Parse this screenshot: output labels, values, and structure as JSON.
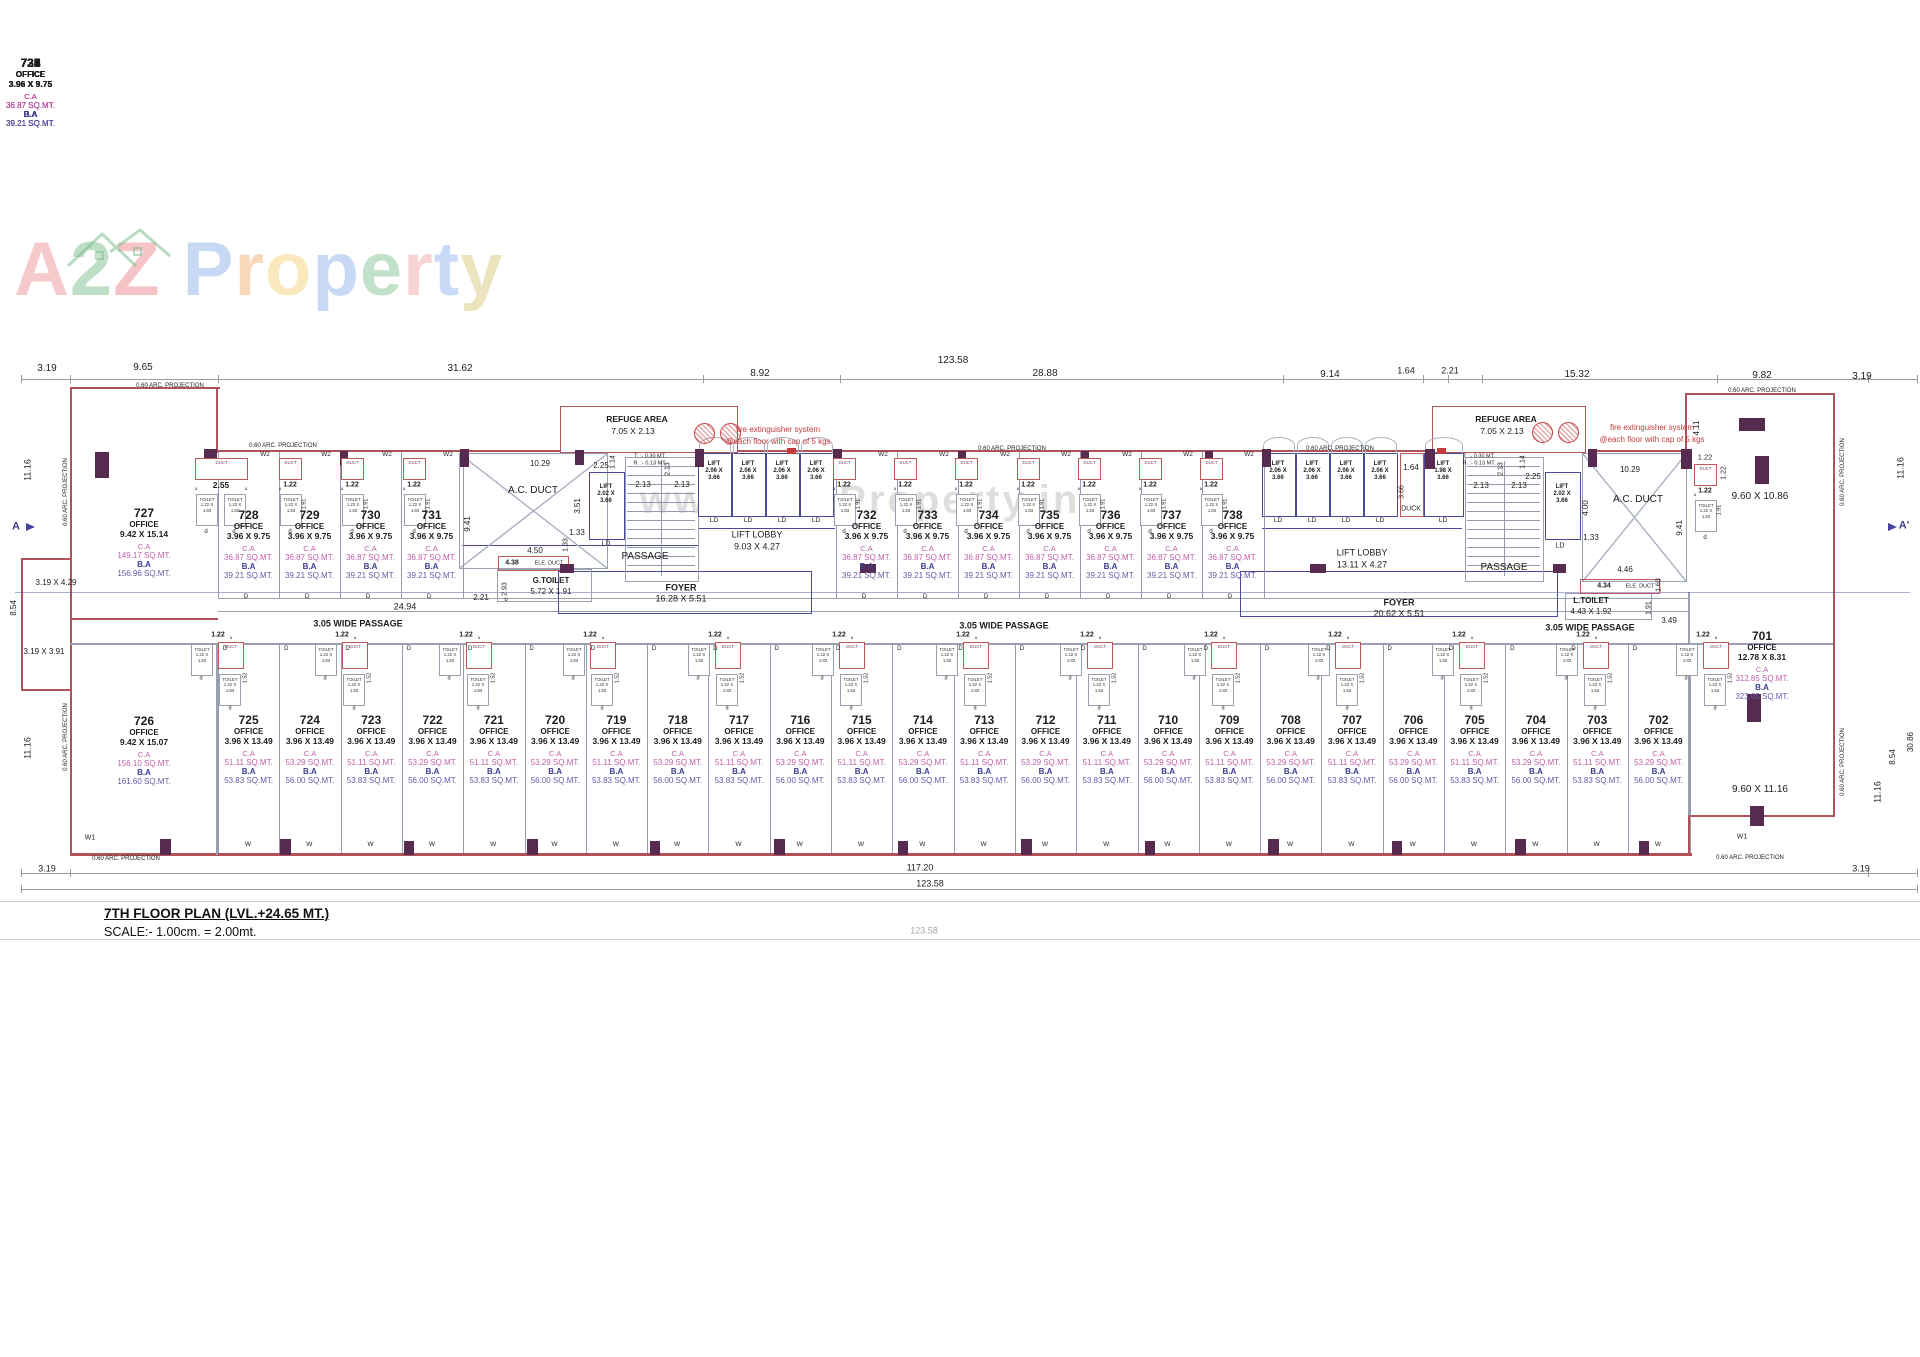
{
  "logo": {
    "word1": [
      {
        "ch": "A",
        "c": "#ef9597"
      },
      {
        "ch": "2",
        "c": "#7fbe8f"
      },
      {
        "ch": "Z",
        "c": "#ee8a90"
      }
    ],
    "word2": [
      {
        "ch": "P",
        "c": "#8fb3ea"
      },
      {
        "ch": "r",
        "c": "#f2b079"
      },
      {
        "ch": "o",
        "c": "#f6d57e"
      },
      {
        "ch": "p",
        "c": "#93b5ec"
      },
      {
        "ch": "e",
        "c": "#84c492"
      },
      {
        "ch": "r",
        "c": "#f0a9a9"
      },
      {
        "ch": "t",
        "c": "#95b7ee"
      },
      {
        "ch": "y",
        "c": "#d9cb7f"
      }
    ]
  },
  "watermark_text": "www.A2ZProperty.in",
  "title_block": {
    "line1": "7TH FLOOR PLAN (LVL.+24.65 MT.)",
    "line2": "SCALE:- 1.00cm. = 2.00mt."
  },
  "labels": {
    "office": "OFFICE",
    "ca": "C.A",
    "ba": "B.A",
    "lift": "LIFT",
    "lift_w": "2.06 X",
    "lift_h": "3.66",
    "ld": "LD",
    "toilet": "TOILET",
    "toilet_w": "1.22 X",
    "toilet_h": "1.83",
    "duct": "DUCT",
    "duck": "DUCK",
    "w2": "W2",
    "door": "D",
    "window": "W",
    "d_small": "d",
    "u_small": "u",
    "dim_122": "1.22",
    "dim_255": "2.55",
    "dim_152": "1.52",
    "dim_191": "1.91"
  },
  "lift_small": {
    "w": "2.02 X"
  },
  "lift_198": {
    "w": "1.98 X"
  },
  "office_701": {
    "no": "701",
    "size": "12.78 X 8.31",
    "ca": "312.85 SQ.MT.",
    "ba": "323.05 SQ.MT."
  },
  "offices_top": [
    {
      "no": "727",
      "size": "9.42 X 15.14",
      "ca": "149.17 SQ.MT.",
      "ba": "156.96 SQ.MT."
    },
    {
      "no": "728",
      "size": "3.96 X 9.75",
      "ca": "36.87 SQ.MT.",
      "ba": "39.21 SQ.MT."
    },
    {
      "no": "729",
      "size": "3.96 X 9.75",
      "ca": "36.87 SQ.MT.",
      "ba": "39.21 SQ.MT."
    },
    {
      "no": "730",
      "size": "3.96 X 9.75",
      "ca": "36.87 SQ.MT.",
      "ba": "39.21 SQ.MT."
    },
    {
      "no": "731",
      "size": "3.96 X 9.75",
      "ca": "36.87 SQ.MT.",
      "ba": "39.21 SQ.MT."
    },
    {
      "no": "732",
      "size": "3.96 X 9.75",
      "ca": "36.87 SQ.MT.",
      "ba": "39.21 SQ.MT."
    },
    {
      "no": "733",
      "size": "3.96 X 9.75",
      "ca": "36.87 SQ.MT.",
      "ba": "39.21 SQ.MT."
    },
    {
      "no": "734",
      "size": "3.96 X 9.75",
      "ca": "36.87 SQ.MT.",
      "ba": "39.21 SQ.MT."
    },
    {
      "no": "735",
      "size": "3.96 X 9.75",
      "ca": "36.87 SQ.MT.",
      "ba": "39.21 SQ.MT."
    },
    {
      "no": "736",
      "size": "3.96 X 9.75",
      "ca": "36.87 SQ.MT.",
      "ba": "39.21 SQ.MT."
    },
    {
      "no": "737",
      "size": "3.96 X 9.75",
      "ca": "36.87 SQ.MT.",
      "ba": "39.21 SQ.MT."
    },
    {
      "no": "738",
      "size": "3.96 X 9.75",
      "ca": "36.87 SQ.MT.",
      "ba": "39.21 SQ.MT."
    }
  ],
  "offices_bottom": [
    {
      "no": "726",
      "size": "9.42 X 15.07",
      "ca": "156.10 SQ.MT.",
      "ba": "161.60 SQ.MT."
    },
    {
      "no": "725",
      "size": "3.96 X 13.49",
      "ca": "51.11 SQ.MT.",
      "ba": "53.83 SQ.MT."
    },
    {
      "no": "724",
      "size": "3.96 X 13.49",
      "ca": "53.29 SQ.MT.",
      "ba": "56.00 SQ.MT."
    },
    {
      "no": "723",
      "size": "3.96 X 13.49",
      "ca": "51.11 SQ.MT.",
      "ba": "53.83 SQ.MT."
    },
    {
      "no": "722",
      "size": "3.96 X 13.49",
      "ca": "53.29 SQ.MT.",
      "ba": "56.00 SQ.MT."
    },
    {
      "no": "721",
      "size": "3.96 X 13.49",
      "ca": "51.11 SQ.MT.",
      "ba": "53.83 SQ.MT."
    },
    {
      "no": "720",
      "size": "3.96 X 13.49",
      "ca": "53.29 SQ.MT.",
      "ba": "56.00 SQ.MT."
    },
    {
      "no": "719",
      "size": "3.96 X 13.49",
      "ca": "51.11 SQ.MT.",
      "ba": "53.83 SQ.MT."
    },
    {
      "no": "718",
      "size": "3.96 X 13.49",
      "ca": "53.29 SQ.MT.",
      "ba": "56.00 SQ.MT."
    },
    {
      "no": "717",
      "size": "3.96 X 13.49",
      "ca": "51.11 SQ.MT.",
      "ba": "53.83 SQ.MT."
    },
    {
      "no": "716",
      "size": "3.96 X 13.49",
      "ca": "53.29 SQ.MT.",
      "ba": "56.00 SQ.MT."
    },
    {
      "no": "715",
      "size": "3.96 X 13.49",
      "ca": "51.11 SQ.MT.",
      "ba": "53.83 SQ.MT."
    },
    {
      "no": "714",
      "size": "3.96 X 13.49",
      "ca": "53.29 SQ.MT.",
      "ba": "56.00 SQ.MT."
    },
    {
      "no": "713",
      "size": "3.96 X 13.49",
      "ca": "51.11 SQ.MT.",
      "ba": "53.83 SQ.MT."
    },
    {
      "no": "712",
      "size": "3.96 X 13.49",
      "ca": "53.29 SQ.MT.",
      "ba": "56.00 SQ.MT."
    },
    {
      "no": "711",
      "size": "3.96 X 13.49",
      "ca": "51.11 SQ.MT.",
      "ba": "53.83 SQ.MT."
    },
    {
      "no": "710",
      "size": "3.96 X 13.49",
      "ca": "53.29 SQ.MT.",
      "ba": "56.00 SQ.MT."
    },
    {
      "no": "709",
      "size": "3.96 X 13.49",
      "ca": "51.11 SQ.MT.",
      "ba": "53.83 SQ.MT."
    },
    {
      "no": "708",
      "size": "3.96 X 13.49",
      "ca": "53.29 SQ.MT.",
      "ba": "56.00 SQ.MT."
    },
    {
      "no": "707",
      "size": "3.96 X 13.49",
      "ca": "51.11 SQ.MT.",
      "ba": "53.83 SQ.MT."
    },
    {
      "no": "706",
      "size": "3.96 X 13.49",
      "ca": "53.29 SQ.MT.",
      "ba": "56.00 SQ.MT."
    },
    {
      "no": "705",
      "size": "3.96 X 13.49",
      "ca": "51.11 SQ.MT.",
      "ba": "53.83 SQ.MT."
    },
    {
      "no": "704",
      "size": "3.96 X 13.49",
      "ca": "53.29 SQ.MT.",
      "ba": "56.00 SQ.MT."
    },
    {
      "no": "703",
      "size": "3.96 X 13.49",
      "ca": "51.11 SQ.MT.",
      "ba": "53.83 SQ.MT."
    },
    {
      "no": "702",
      "size": "3.96 X 13.49",
      "ca": "53.29 SQ.MT.",
      "ba": "56.00 SQ.MT."
    }
  ],
  "annotations": [
    {
      "t": "3.19",
      "x": 47,
      "y": 369,
      "s": 10
    },
    {
      "t": "9.65",
      "x": 143,
      "y": 368,
      "s": 10
    },
    {
      "t": "31.62",
      "x": 460,
      "y": 369,
      "s": 10
    },
    {
      "t": "8.92",
      "x": 760,
      "y": 374,
      "s": 10
    },
    {
      "t": "123.58",
      "x": 953,
      "y": 361,
      "s": 10
    },
    {
      "t": "28.88",
      "x": 1045,
      "y": 374,
      "s": 10
    },
    {
      "t": "9.14",
      "x": 1330,
      "y": 375,
      "s": 10
    },
    {
      "t": "1.64",
      "x": 1406,
      "y": 371,
      "s": 9
    },
    {
      "t": "2.21",
      "x": 1450,
      "y": 371,
      "s": 9
    },
    {
      "t": "15.32",
      "x": 1577,
      "y": 375,
      "s": 10
    },
    {
      "t": "9.82",
      "x": 1762,
      "y": 376,
      "s": 10
    },
    {
      "t": "3.19",
      "x": 1862,
      "y": 377,
      "s": 10
    },
    {
      "t": "0.60 ARC. PROJECTION",
      "x": 170,
      "y": 386,
      "s": 6
    },
    {
      "t": "0.60 ARC. PROJECTION",
      "x": 283,
      "y": 446,
      "s": 6
    },
    {
      "t": "0.60 ARC. PROJECTION",
      "x": 1012,
      "y": 449,
      "s": 6
    },
    {
      "t": "0.60 ARC. PROJECTION",
      "x": 1340,
      "y": 449,
      "s": 6
    },
    {
      "t": "0.60 ARC. PROJECTION",
      "x": 1762,
      "y": 391,
      "s": 6
    },
    {
      "t": "0.60 ARC. PROJECTION",
      "x": 126,
      "y": 859,
      "s": 6
    },
    {
      "t": "0.60 ARC. PROJECTION",
      "x": 1750,
      "y": 858,
      "s": 6
    },
    {
      "t": "0.60 ARC. PROJECTION",
      "x": 66,
      "y": 492,
      "s": 6,
      "r": 1
    },
    {
      "t": "0.60 ARC. PROJECTION",
      "x": 66,
      "y": 737,
      "s": 6,
      "r": 1
    },
    {
      "t": "0.60 ARC. PROJECTION",
      "x": 1843,
      "y": 472,
      "s": 6,
      "r": 1
    },
    {
      "t": "0.60 ARC. PROJECTION",
      "x": 1843,
      "y": 762,
      "s": 6,
      "r": 1
    },
    {
      "t": "11.16",
      "x": 28,
      "y": 470,
      "s": 9,
      "r": 1
    },
    {
      "t": "8.54",
      "x": 14,
      "y": 608,
      "s": 8,
      "r": 1
    },
    {
      "t": "11.16",
      "x": 28,
      "y": 748,
      "s": 9,
      "r": 1
    },
    {
      "t": "3.19 X 4.29",
      "x": 56,
      "y": 583,
      "s": 8
    },
    {
      "t": "3.19 X 3.91",
      "x": 44,
      "y": 652,
      "s": 8
    },
    {
      "t": "A",
      "x": 16,
      "y": 527,
      "s": 11,
      "b": 1,
      "c": "nvy"
    },
    {
      "t": "W1",
      "x": 90,
      "y": 838,
      "s": 7
    },
    {
      "t": "4.11",
      "x": 1697,
      "y": 428,
      "s": 8,
      "r": 1
    },
    {
      "t": "11.16",
      "x": 1901,
      "y": 468,
      "s": 9,
      "r": 1
    },
    {
      "t": "A'",
      "x": 1904,
      "y": 526,
      "s": 11,
      "b": 1,
      "c": "nvy"
    },
    {
      "t": "9.60 X 10.86",
      "x": 1760,
      "y": 497,
      "s": 10
    },
    {
      "t": "8.54",
      "x": 1893,
      "y": 757,
      "s": 8,
      "r": 1
    },
    {
      "t": "30.86",
      "x": 1911,
      "y": 742,
      "s": 8,
      "r": 1
    },
    {
      "t": "11.16",
      "x": 1878,
      "y": 792,
      "s": 9,
      "r": 1
    },
    {
      "t": "9.60 X 11.16",
      "x": 1760,
      "y": 790,
      "s": 10
    },
    {
      "t": "W1",
      "x": 1742,
      "y": 837,
      "s": 7
    },
    {
      "t": "REFUGE AREA",
      "x": 637,
      "y": 419,
      "s": 8.5,
      "b": 1
    },
    {
      "t": "7.05 X 2.13",
      "x": 633,
      "y": 431,
      "s": 8.5
    },
    {
      "t": "fire extinguisher system",
      "x": 778,
      "y": 430,
      "s": 8,
      "c": "red"
    },
    {
      "t": "@each floor with cap of 5 kgs",
      "x": 778,
      "y": 442,
      "s": 8,
      "c": "red"
    },
    {
      "t": "REFUGE AREA",
      "x": 1506,
      "y": 419,
      "s": 8.5,
      "b": 1
    },
    {
      "t": "7.05 X 2.13",
      "x": 1502,
      "y": 431,
      "s": 8.5
    },
    {
      "t": "fire extinguisher system",
      "x": 1652,
      "y": 428,
      "s": 8,
      "c": "red"
    },
    {
      "t": "@each floor with cap of 5 kgs",
      "x": 1652,
      "y": 440,
      "s": 8,
      "c": "red"
    },
    {
      "t": "10.29",
      "x": 540,
      "y": 464,
      "s": 8
    },
    {
      "t": "A.C. DUCT",
      "x": 533,
      "y": 491,
      "s": 10
    },
    {
      "t": "9.41",
      "x": 468,
      "y": 524,
      "s": 8,
      "r": 1
    },
    {
      "t": "3.51",
      "x": 578,
      "y": 506,
      "s": 8,
      "r": 1
    },
    {
      "t": "1.33",
      "x": 577,
      "y": 533,
      "s": 8
    },
    {
      "t": "2.25",
      "x": 601,
      "y": 466,
      "s": 8
    },
    {
      "t": "1.14",
      "x": 613,
      "y": 462,
      "s": 7,
      "r": 1
    },
    {
      "t": "T. :- 0.30 MT.",
      "x": 650,
      "y": 457,
      "s": 5.5
    },
    {
      "t": "R. :- 0.13 MT.",
      "x": 650,
      "y": 464,
      "s": 5.5
    },
    {
      "t": "2.13",
      "x": 643,
      "y": 485,
      "s": 8
    },
    {
      "t": "2.13",
      "x": 682,
      "y": 485,
      "s": 8
    },
    {
      "t": "2.13",
      "x": 668,
      "y": 469,
      "s": 7,
      "r": 1
    },
    {
      "t": "4.50",
      "x": 535,
      "y": 551,
      "s": 8
    },
    {
      "t": "4.38",
      "x": 512,
      "y": 563,
      "s": 7,
      "b": 1
    },
    {
      "t": "ELE. DUCT",
      "x": 549,
      "y": 564,
      "s": 5.5
    },
    {
      "t": "G.TOILET",
      "x": 551,
      "y": 581,
      "s": 8,
      "b": 1
    },
    {
      "t": "5.72 X 1.91",
      "x": 551,
      "y": 592,
      "s": 8
    },
    {
      "t": "2.93",
      "x": 505,
      "y": 589,
      "s": 7,
      "r": 1
    },
    {
      "t": "2.21",
      "x": 481,
      "y": 598,
      "s": 8
    },
    {
      "t": "1.33",
      "x": 566,
      "y": 545,
      "s": 7,
      "r": 1
    },
    {
      "t": "PASSAGE",
      "x": 645,
      "y": 557,
      "s": 10
    },
    {
      "t": "FOYER",
      "x": 681,
      "y": 588,
      "s": 9,
      "b": 1
    },
    {
      "t": "16.28 X 5.51",
      "x": 681,
      "y": 599,
      "s": 9
    },
    {
      "t": "LIFT LOBBY",
      "x": 757,
      "y": 535,
      "s": 9
    },
    {
      "t": "9.03 X 4.27",
      "x": 757,
      "y": 547,
      "s": 9
    },
    {
      "t": "24.94",
      "x": 405,
      "y": 607,
      "s": 9
    },
    {
      "t": "3.05 WIDE PASSAGE",
      "x": 358,
      "y": 624,
      "s": 9,
      "b": 1
    },
    {
      "t": "3.05 WIDE PASSAGE",
      "x": 1004,
      "y": 626,
      "s": 9,
      "b": 1
    },
    {
      "t": "3.05 WIDE PASSAGE",
      "x": 1590,
      "y": 628,
      "s": 9,
      "b": 1
    },
    {
      "t": "1.64",
      "x": 1411,
      "y": 468,
      "s": 8
    },
    {
      "t": "3.66",
      "x": 1402,
      "y": 492,
      "s": 7,
      "r": 1
    },
    {
      "t": "DUCK",
      "x": 1411,
      "y": 509,
      "s": 7
    },
    {
      "t": "2.13",
      "x": 1481,
      "y": 486,
      "s": 8
    },
    {
      "t": "2.13",
      "x": 1519,
      "y": 486,
      "s": 8
    },
    {
      "t": "2.13",
      "x": 1501,
      "y": 469,
      "s": 7,
      "r": 1
    },
    {
      "t": "T. :- 0.30 MT.",
      "x": 1479,
      "y": 457,
      "s": 5.5
    },
    {
      "t": "R. :- 0.13 MT.",
      "x": 1479,
      "y": 464,
      "s": 5.5
    },
    {
      "t": "2.25",
      "x": 1533,
      "y": 477,
      "s": 8
    },
    {
      "t": "1.14",
      "x": 1523,
      "y": 462,
      "s": 7,
      "r": 1
    },
    {
      "t": "4.00",
      "x": 1586,
      "y": 508,
      "s": 8,
      "r": 1
    },
    {
      "t": "1.33",
      "x": 1591,
      "y": 538,
      "s": 8
    },
    {
      "t": "10.29",
      "x": 1630,
      "y": 470,
      "s": 8
    },
    {
      "t": "A.C. DUCT",
      "x": 1638,
      "y": 500,
      "s": 10
    },
    {
      "t": "9.41",
      "x": 1680,
      "y": 528,
      "s": 8,
      "r": 1
    },
    {
      "t": "LIFT LOBBY",
      "x": 1362,
      "y": 553,
      "s": 9
    },
    {
      "t": "13.11 X 4.27",
      "x": 1362,
      "y": 565,
      "s": 9
    },
    {
      "t": "PASSAGE",
      "x": 1504,
      "y": 568,
      "s": 10
    },
    {
      "t": "4.46",
      "x": 1625,
      "y": 570,
      "s": 8
    },
    {
      "t": "4.34",
      "x": 1604,
      "y": 586,
      "s": 7,
      "b": 1
    },
    {
      "t": "ELE. DUCT",
      "x": 1640,
      "y": 587,
      "s": 5.5
    },
    {
      "t": "L.TOILET",
      "x": 1591,
      "y": 601,
      "s": 8,
      "b": 1
    },
    {
      "t": "4.43 X 1.92",
      "x": 1591,
      "y": 612,
      "s": 8
    },
    {
      "t": "1.91",
      "x": 1649,
      "y": 608,
      "s": 7,
      "r": 1
    },
    {
      "t": "3.49",
      "x": 1669,
      "y": 621,
      "s": 8
    },
    {
      "t": "1.63",
      "x": 1659,
      "y": 585,
      "s": 7,
      "r": 1
    },
    {
      "t": "FOYER",
      "x": 1399,
      "y": 603,
      "s": 9,
      "b": 1
    },
    {
      "t": "20.62 X 5.51",
      "x": 1399,
      "y": 614,
      "s": 9
    },
    {
      "t": "1.22",
      "x": 1705,
      "y": 457,
      "s": 7.5
    },
    {
      "t": "1.22",
      "x": 1724,
      "y": 473,
      "s": 7,
      "r": 1
    },
    {
      "t": "LD",
      "x": 606,
      "y": 544,
      "s": 7
    },
    {
      "t": "LD",
      "x": 1560,
      "y": 546,
      "s": 7
    },
    {
      "t": "u",
      "x": 506,
      "y": 600,
      "s": 6
    },
    {
      "t": "117.20",
      "x": 920,
      "y": 868,
      "s": 9
    },
    {
      "t": "123.58",
      "x": 930,
      "y": 884,
      "s": 9
    },
    {
      "t": "3.19",
      "x": 47,
      "y": 869,
      "s": 9
    },
    {
      "t": "3.19",
      "x": 1861,
      "y": 869,
      "s": 9
    },
    {
      "t": "123.58",
      "x": 924,
      "y": 931,
      "s": 9,
      "c": "gry"
    }
  ]
}
